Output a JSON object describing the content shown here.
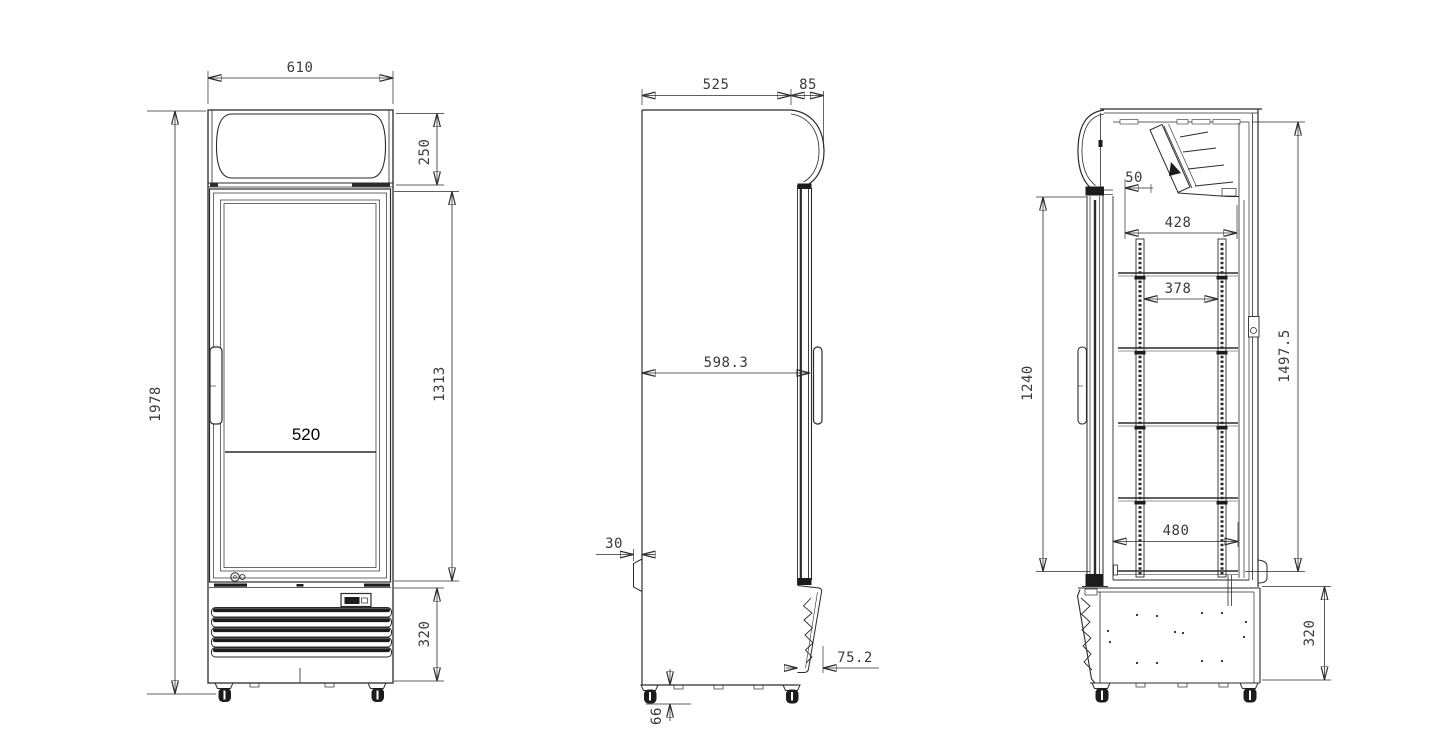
{
  "colors": {
    "background": "#ffffff",
    "line": "#2b2b2b",
    "dimension_text": "#3a3a3a",
    "dark_fill": "#1c1c1c"
  },
  "views": {
    "front": {
      "dims": {
        "overall_width": "610",
        "canopy_height": "250",
        "door_opening_height": "1313",
        "overall_height": "1978",
        "shelf_width": "520",
        "base_height": "320"
      }
    },
    "side": {
      "dims": {
        "body_depth": "525",
        "door_depth": "85",
        "overall_depth": "598.3",
        "rear_spacer": "30",
        "grille_depth": "75.2",
        "caster_height": "66"
      }
    },
    "section": {
      "dims": {
        "top_gap": "50",
        "evaporator_recess_width": "428",
        "shelf_rail_span": "378",
        "door_glass_height": "1240",
        "interior_height": "1497.5",
        "bottom_shelf_width": "480",
        "machine_compartment_height": "320"
      }
    }
  }
}
